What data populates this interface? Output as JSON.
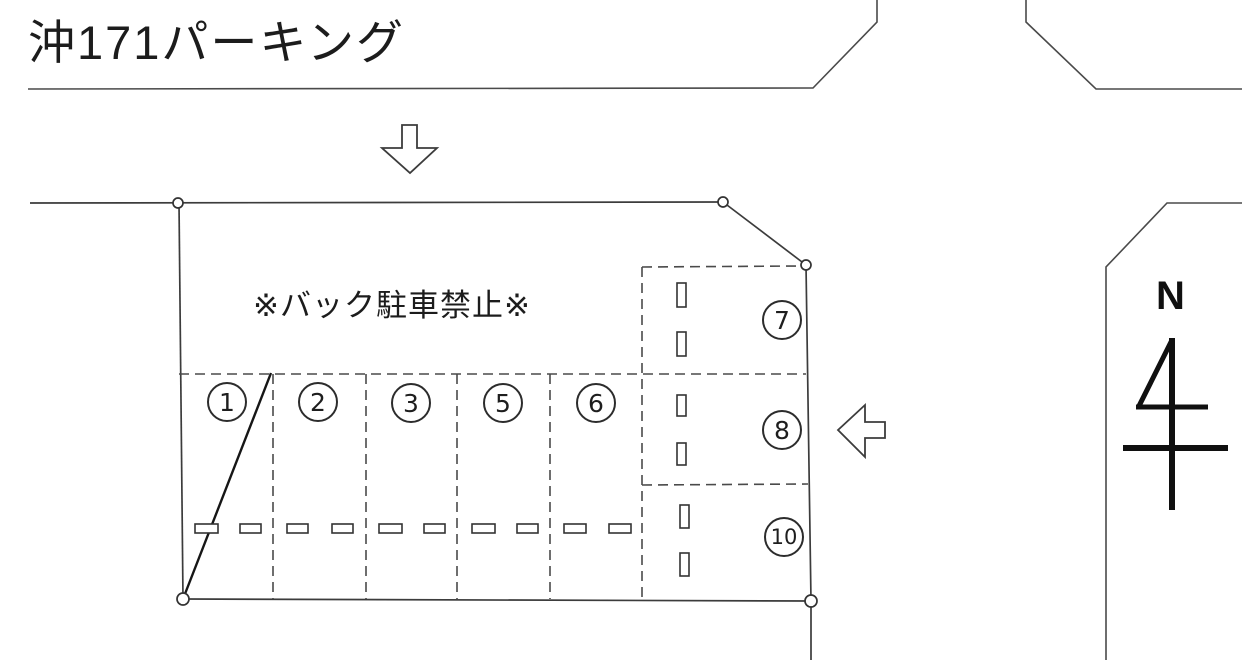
{
  "title": "沖171パーキング",
  "note": "※バック駐車禁止※",
  "compass": {
    "label": "N"
  },
  "parking": {
    "row_spots": [
      "1",
      "2",
      "3",
      "5",
      "6"
    ],
    "side_spots": [
      "7",
      "8",
      "10"
    ]
  },
  "icons": {
    "entrance_arrow": "down-arrow",
    "side_entry_arrow": "left-arrow",
    "north_mark": "north-symbol"
  },
  "colors": {
    "background": "#ffffff",
    "line": "#3f3f3f",
    "ink": "#1b1b1b"
  }
}
